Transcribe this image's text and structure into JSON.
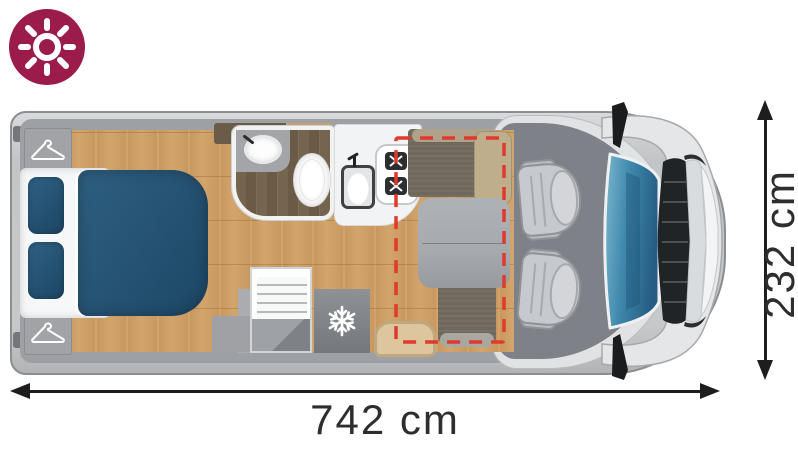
{
  "dimensions": {
    "length": {
      "label": "742 cm"
    },
    "width": {
      "label": "232 cm"
    }
  },
  "badge": {
    "icon": "sun-icon"
  },
  "floorplan": {
    "type": "motorhome-floorplan-top-view",
    "areas": [
      {
        "name": "rear-bedroom",
        "features": [
          "wardrobe-top",
          "wardrobe-bottom",
          "double-bed",
          "pillow",
          "pillow",
          "duvet"
        ]
      },
      {
        "name": "bathroom",
        "features": [
          "washbasin",
          "faucet",
          "toilet"
        ]
      },
      {
        "name": "kitchen",
        "features": [
          "kitchen-sink",
          "two-burner-hob",
          "refrigerator",
          "louvered-cabinet",
          "entry-step"
        ]
      },
      {
        "name": "dinette",
        "features": [
          "front-bench-seat",
          "rear-bench-seat",
          "dinette-table",
          "side-seat",
          "drop-down-bed-outline"
        ]
      },
      {
        "name": "cab",
        "features": [
          "driver-swivel-seat",
          "passenger-swivel-seat",
          "windshield",
          "grille",
          "side-mirror-top",
          "side-mirror-bottom"
        ]
      }
    ],
    "icons": [
      "sun-icon",
      "hanger-icon",
      "snowflake-icon",
      "burner-icon"
    ]
  },
  "colors": {
    "badge": "#9B1B4B",
    "dash_red": "#E0392D",
    "bed_blue": "#2E5F80",
    "bed_blue_dark": "#1D4766",
    "wood": "#CD9D64",
    "wood_dark": "#6F5E49",
    "wall_gray": "#9DA0A4",
    "shell_gray": "#C9CBCD",
    "cab_floor": "#7E8187",
    "bench": "#6F685C",
    "cushion_beige": "#DDC69E",
    "seat_gray": "#C6C9CD",
    "table_gray": "#A6A9AD",
    "windshield_blue": "#4089AD",
    "dim_text": "#2E2E2E"
  }
}
